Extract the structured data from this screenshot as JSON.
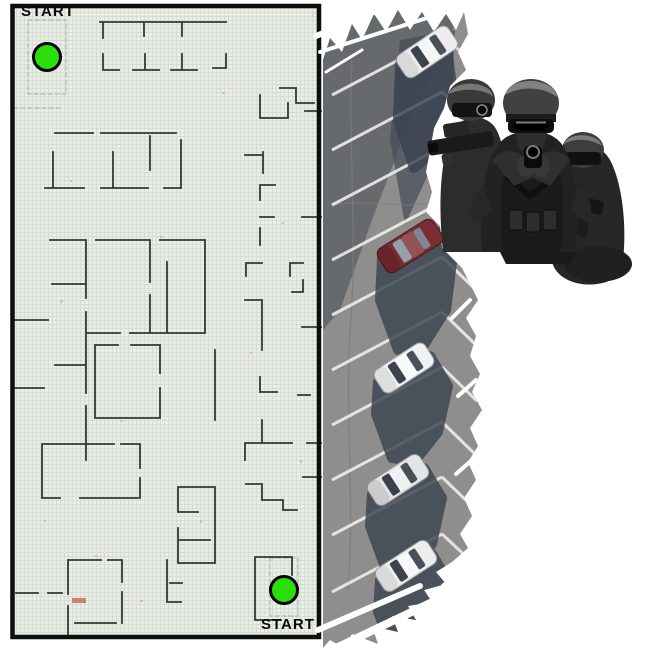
{
  "map": {
    "start_top": {
      "label": "START"
    },
    "start_bottom": {
      "label": "START"
    },
    "start_points": [
      {
        "x": 32,
        "y": 42
      },
      {
        "x": 269,
        "y": 575
      }
    ],
    "colors": {
      "background": "#ebeee8",
      "grid": "#c9d5c8",
      "wall": "#2f3a35",
      "border": "#0e0e0e",
      "start_dot": "#2bdf0d",
      "start_dot_border": "#000000"
    }
  },
  "lot": {
    "colors": {
      "asphalt": "#8f8e8c",
      "stripe": "#ebebeb",
      "car_shadow": "#3a4450",
      "building_shadow": "#5a5e63"
    },
    "cars": [
      {
        "name": "white-car-top",
        "color": "#ececec"
      },
      {
        "name": "dark-red-car",
        "color": "#7c2c33"
      },
      {
        "name": "white-car-middle",
        "color": "#f0f1f2"
      },
      {
        "name": "silver-car",
        "color": "#e2e4e6"
      },
      {
        "name": "white-car-bottom",
        "color": "#ededee"
      }
    ]
  },
  "photo": {
    "name": "swat-team",
    "figures": 3
  }
}
